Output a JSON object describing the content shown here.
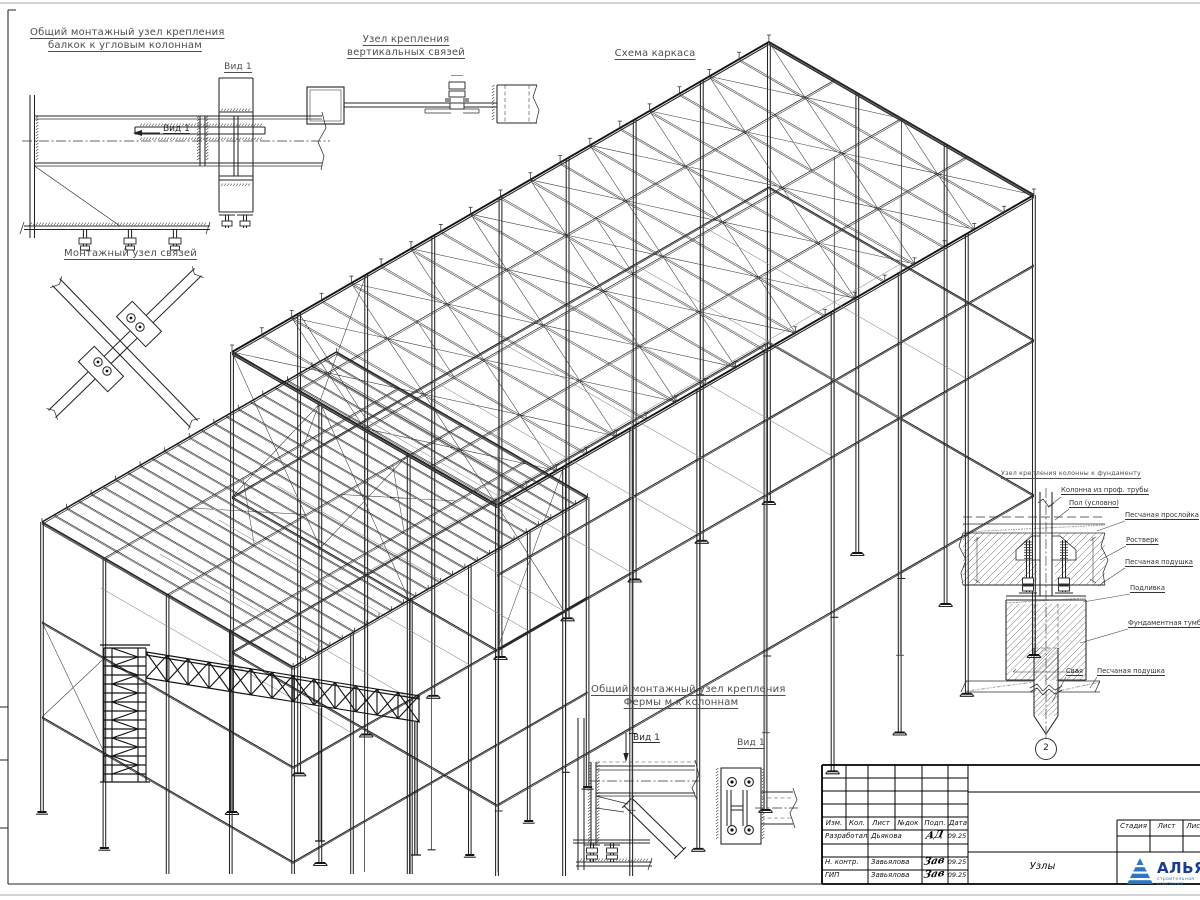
{
  "titles": {
    "detail_corner_line1": "Общий монтажный узел крепления",
    "detail_corner_line2": "балкок к угловым колоннам",
    "detail_vbrace_line1": "Узел крепления",
    "detail_vbrace_line2": "вертикальных связей",
    "frame_scheme": "Схема каркаса",
    "detail_brace": "Монтажный узел связей",
    "detail_foundation": "Узел крепления колонны к фундаменту",
    "detail_truss_line1": "Общий монтажный узел крепления",
    "detail_truss_line2": "Фермы м к колоннам"
  },
  "view_labels": {
    "view1": "Вид 1"
  },
  "foundation_labels": {
    "column": "Колонна из проф. трубы",
    "floor": "Пол (условно)",
    "sand_layer": "Песчаная прослойка",
    "grillage": "Ростверк",
    "sand_cushion": "Песчаная подушка",
    "grout": "Подливка",
    "pedestal": "Фундаментная тумба",
    "pile": "Свая",
    "sand_cushion2": "Песчаная подушка",
    "marker": "2"
  },
  "title_block": {
    "header_cols": [
      "Изм.",
      "Кол.",
      "Лист",
      "№док",
      "Подп.",
      "Дата"
    ],
    "rows": [
      {
        "role": "Разработал",
        "name": "Дьякова",
        "sig": "АД",
        "date": "09.25"
      },
      {
        "role": "Н. контр.",
        "name": "Завьялова",
        "sig": "Зав",
        "date": "09.25"
      },
      {
        "role": "ГИП",
        "name": "Завьялова",
        "sig": "Зав",
        "date": "09.25"
      }
    ],
    "doc_title": "Узлы",
    "stage_cols": [
      "Стадия",
      "Лист",
      "Листов"
    ],
    "logo_text": "АЛЬЯНС",
    "logo_sub": "строительная компания",
    "colors": {
      "logo_blue": "#2b77c5",
      "logo_navy": "#1c3c8f"
    }
  }
}
